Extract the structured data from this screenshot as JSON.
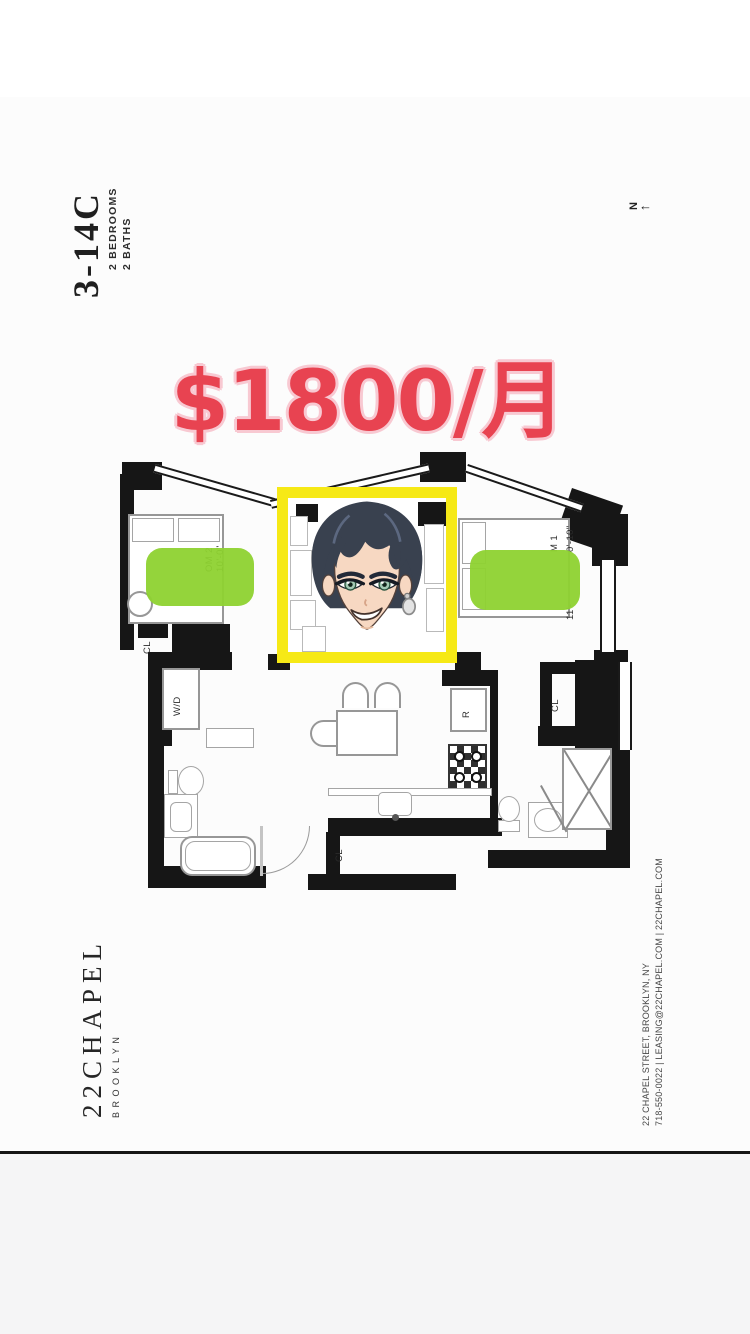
{
  "unit": {
    "number": "3-14C",
    "spec1": "2 BEDROOMS",
    "spec2": "2 BATHS"
  },
  "compass": {
    "n": "N",
    "arrow": "←"
  },
  "price": {
    "text": "$1800/月"
  },
  "plan": {
    "bedroom2": {
      "name": "OM 2",
      "dim": "10'-0\""
    },
    "bedroom1": {
      "name": "M 1",
      "dim_top": "0'-10\"",
      "dim_bottom": "11'-"
    },
    "labels": {
      "cl1": "CL",
      "cl2": "CL",
      "cl3": "CL",
      "wd": "W/D",
      "fridge": "R"
    }
  },
  "brand": {
    "logo": "22CHAPEL",
    "sub": "BROOKLYN",
    "address": "22 CHAPEL STREET, BROOKLYN, NY",
    "contact": "718-550-0022  |  LEASING@22CHAPEL.COM  |  22CHAPEL.COM"
  },
  "colors": {
    "price_red": "#e84351",
    "price_outline": "#f8c9d2",
    "highlight_green": "#8ed230",
    "box_yellow": "#f6e916",
    "wall_black": "#161616"
  }
}
